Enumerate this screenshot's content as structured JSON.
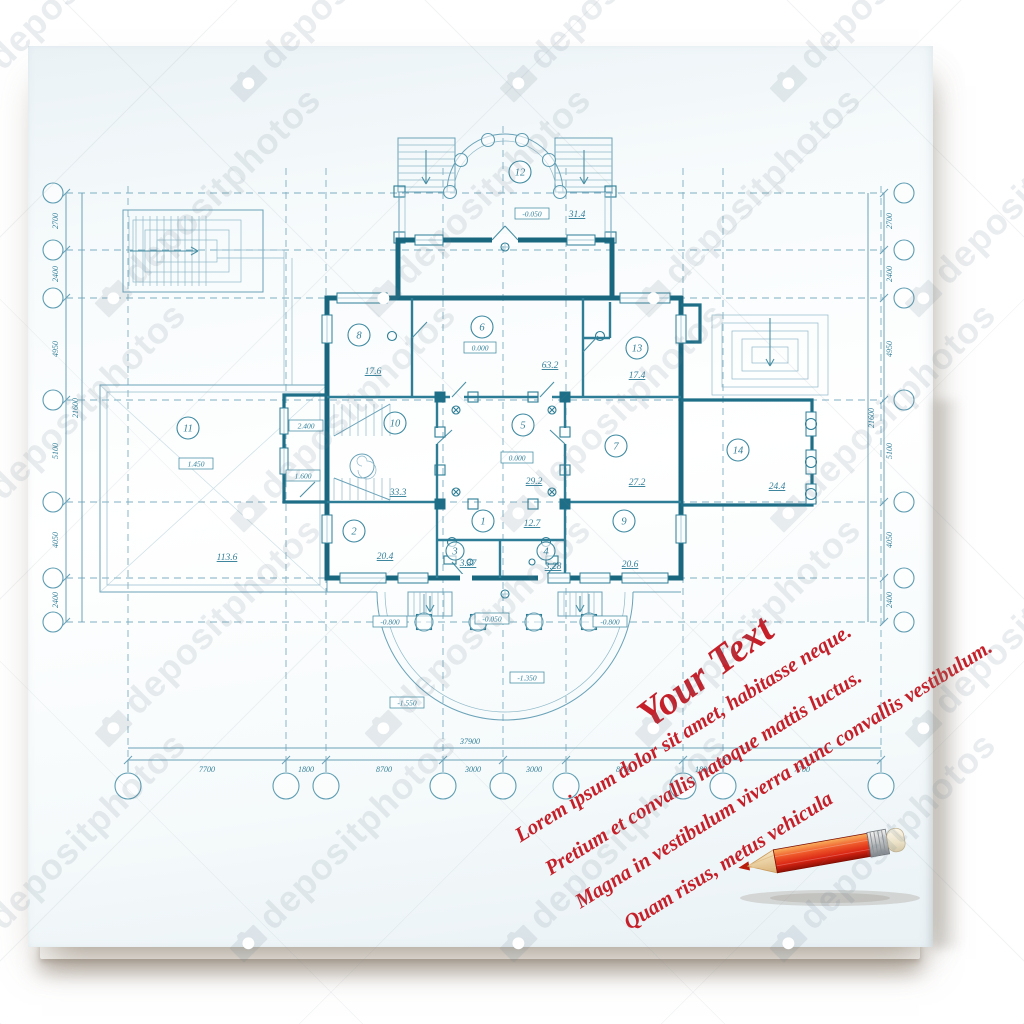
{
  "watermark": {
    "text": "depositphotos"
  },
  "annotation": {
    "title": "Your Text",
    "color": "#c5202a",
    "lines": [
      "Lorem ipsum dolor sit amet, habitasse neque.",
      "Pretium et convallis natoque mattis luctus.",
      "Magna in vestibulum viverra nunc convallis vestibulum.",
      "Quam risus, metus vehicula"
    ]
  },
  "blueprint": {
    "ink_color": "#1d6e86",
    "dims_left": {
      "total": "21600",
      "segments": [
        "2700",
        "2400",
        "4950",
        "5100",
        "4050",
        "2400"
      ]
    },
    "dims_right": {
      "total": "21600",
      "segments": [
        "2700",
        "2400",
        "4950",
        "5100",
        "4050",
        "2400"
      ]
    },
    "dims_bottom": {
      "total": "37900",
      "segments": [
        "7700",
        "1800",
        "8700",
        "3000",
        "3000",
        "8700",
        "1800",
        "7700"
      ]
    },
    "rooms": [
      {
        "num": "12",
        "area": "31.4"
      },
      {
        "num": "8",
        "area": "17.6"
      },
      {
        "num": "6",
        "area": "63.2"
      },
      {
        "num": "13",
        "area": "17.4"
      },
      {
        "num": "11",
        "area": "113.6"
      },
      {
        "num": "10",
        "area": "33.3"
      },
      {
        "num": "5",
        "area": "29.2"
      },
      {
        "num": "7",
        "area": "27.2"
      },
      {
        "num": "14",
        "area": "24.4"
      },
      {
        "num": "2",
        "area": "20.4"
      },
      {
        "num": "1",
        "area": "12.7"
      },
      {
        "num": "3",
        "area": "3.37"
      },
      {
        "num": "4",
        "area": "3.28"
      },
      {
        "num": "9",
        "area": "20.6"
      }
    ],
    "levels": {
      "portico": "-0.050",
      "room6": "0.000",
      "room5": "0.000",
      "room10_upper": "2.400",
      "room10_lower": "1.600",
      "room11": "1.450",
      "porch_left": "-0.800",
      "porch_right": "-0.800",
      "porch_center": "-0.050",
      "porch_mid": "-1.350",
      "porch_low": "-1.550"
    }
  }
}
